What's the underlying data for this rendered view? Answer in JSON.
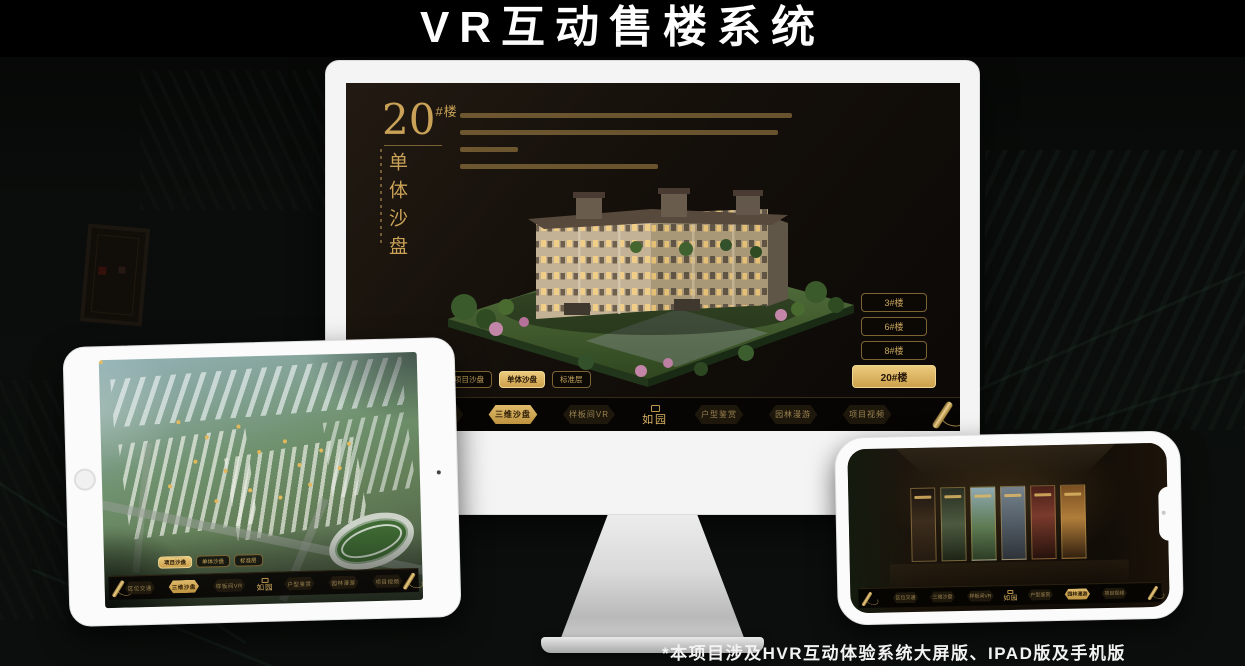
{
  "page": {
    "title": "VR互动售楼系统",
    "footnote": "*本项目涉及HVR互动体验系统大屏版、IPAD版及手机版"
  },
  "colors": {
    "gold": "#c9a153",
    "gold_active": "#d8ae5d",
    "screen_bg": "#14100b",
    "device_frame": "#f4f4f4"
  },
  "shared": {
    "logo": "如园",
    "tabs": [
      "项目沙盘",
      "单体沙盘",
      "标准层"
    ],
    "nav_items": [
      "区位交通",
      "三维沙盘",
      "样板间VR",
      "户型鉴赏",
      "园林漫游",
      "项目视频"
    ]
  },
  "desktop": {
    "hero": {
      "number": "20",
      "suffix": "#楼",
      "subtitle": "单体沙盘"
    },
    "floor_buttons": [
      "3#楼",
      "6#楼",
      "8#楼",
      "20#楼"
    ],
    "active_floor": "20#楼",
    "active_tab": "单体沙盘",
    "active_nav": "三维沙盘"
  },
  "tablet": {
    "active_tab": "项目沙盘",
    "active_nav": "三维沙盘"
  },
  "phone": {
    "active_nav": "园林漫游"
  }
}
